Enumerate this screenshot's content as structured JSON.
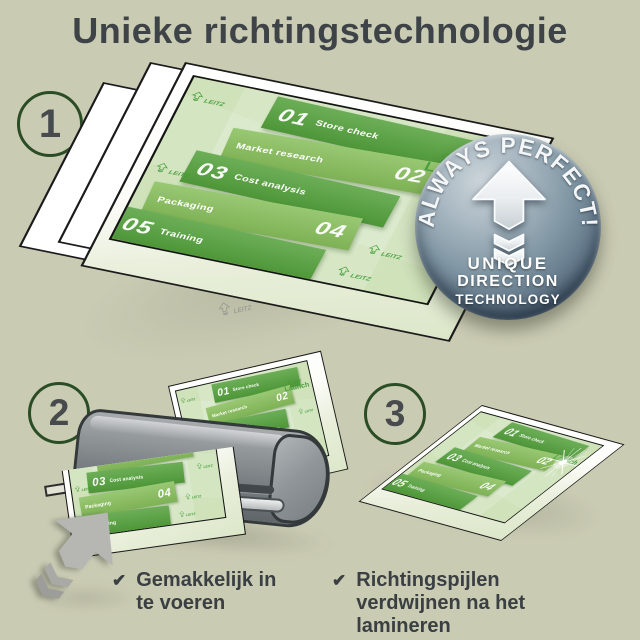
{
  "title": "Unieke richtingstechnologie",
  "steps": {
    "one": "1",
    "two": "2",
    "three": "3"
  },
  "badge": {
    "arc_text": "ALWAYS PERFECT!",
    "line1": "UNIQUE",
    "line2": "DIRECTION",
    "line3": "TECHNOLOGY"
  },
  "doc": {
    "blocks": [
      {
        "num": "01",
        "label": "Store check"
      },
      {
        "num": "02",
        "label": "Market research"
      },
      {
        "num": "03",
        "label": "Cost analysis"
      },
      {
        "num": "04",
        "label": "Packaging"
      },
      {
        "num": "05",
        "label": "Training"
      }
    ],
    "launch": "Launch",
    "watermark": "LEITZ"
  },
  "checklist": {
    "item1": "Gemakkelijk in te voeren",
    "item2": "Richtingspijlen verdwijnen na het lamineren"
  },
  "icons": {
    "check": "✔"
  },
  "colors": {
    "background": "#cacbb3",
    "title_text": "#3d4347",
    "circle_border": "#2b4d26",
    "block_dark": "#54a13c",
    "block_light": "#88bf5c",
    "doc_bg": "#cfe2ba",
    "launch_green": "#4aa23d",
    "badge_steel": "#8298a5",
    "machine_gray": "#83898c",
    "arrow_gray": "#b6b6b2"
  }
}
